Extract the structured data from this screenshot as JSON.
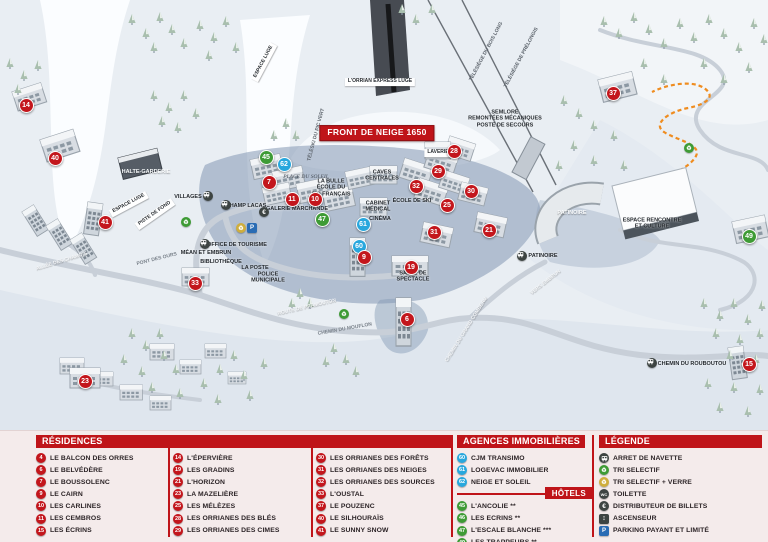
{
  "colors": {
    "red": "#c3161c",
    "blue": "#28a7dd",
    "green": "#3e9b35",
    "dark": "#3d4442",
    "parking": "#2a6cb4",
    "glass": "#cfae3d",
    "header_red": "#bf1419",
    "panel_bg": "#f4ebeb",
    "luge_orange": "#ef8c1f"
  },
  "panel": {
    "residences": {
      "header": "RÉSIDENCES",
      "columns": [
        [
          {
            "n": 4,
            "label": "LE BALCON DES ORRES"
          },
          {
            "n": 6,
            "label": "LE BELVÉDÈRE"
          },
          {
            "n": 7,
            "label": "LE BOUSSOLENC"
          },
          {
            "n": 9,
            "label": "LE CAIRN"
          },
          {
            "n": 10,
            "label": "LES CARLINES"
          },
          {
            "n": 11,
            "label": "LES CEMBROS"
          },
          {
            "n": 15,
            "label": "LES ÉCRINS"
          }
        ],
        [
          {
            "n": 14,
            "label": "L'ÉPERVIÈRE"
          },
          {
            "n": 19,
            "label": "LES GRADINS"
          },
          {
            "n": 21,
            "label": "L'HORIZON"
          },
          {
            "n": 23,
            "label": "LA MAZELIÈRE"
          },
          {
            "n": 25,
            "label": "LES MÉLÈZES"
          },
          {
            "n": 28,
            "label": "LES ORRIANES DES BLÉS"
          },
          {
            "n": 29,
            "label": "LES ORRIANES DES CIMES"
          }
        ],
        [
          {
            "n": 30,
            "label": "LES ORRIANES DES FORÊTS"
          },
          {
            "n": 31,
            "label": "LES ORRIANES DES NEIGES"
          },
          {
            "n": 32,
            "label": "LES ORRIANES DES SOURCES"
          },
          {
            "n": 33,
            "label": "L'OUSTAL"
          },
          {
            "n": 37,
            "label": "LE POUZENC"
          },
          {
            "n": 40,
            "label": "LE SILHOURAÏS"
          },
          {
            "n": 41,
            "label": "LE SUNNY SNOW"
          }
        ]
      ]
    },
    "agencies": {
      "header": "AGENCES IMMOBILIÈRES",
      "items": [
        {
          "n": 60,
          "label": "CJM TRANSIMO"
        },
        {
          "n": 61,
          "label": "LOGEVAC IMMOBILIER"
        },
        {
          "n": 62,
          "label": "NEIGE ET SOLEIL"
        }
      ]
    },
    "hotels": {
      "header": "HÔTELS",
      "items": [
        {
          "n": 45,
          "label": "L'ANCOLIE **"
        },
        {
          "n": 46,
          "label": "LES ECRINS **"
        },
        {
          "n": 47,
          "label": "L'ESCALE BLANCHE ***"
        },
        {
          "n": 49,
          "label": "LES TRAPPEURS **"
        }
      ]
    },
    "legende": {
      "header": "LÉGENDE",
      "items": [
        {
          "icon": "bus-icon",
          "label": "ARRET DE NAVETTE"
        },
        {
          "icon": "recycle-icon",
          "label": "TRI SELECTIF"
        },
        {
          "icon": "recycle-glass-icon",
          "label": "TRI SELECTIF + VERRE"
        },
        {
          "icon": "toilet-icon",
          "label": "TOILETTE"
        },
        {
          "icon": "euro-icon",
          "label": "DISTRIBUTEUR DE BILLETS"
        },
        {
          "icon": "elevator-icon",
          "label": "ASCENSEUR"
        },
        {
          "icon": "parking-icon",
          "label": "PARKING PAYANT ET LIMITÉ"
        }
      ]
    }
  },
  "map": {
    "banner": "FRONT DE NEIGE 1650",
    "markers": [
      {
        "n": 14,
        "x": 25,
        "y": 104,
        "c": "r"
      },
      {
        "n": 40,
        "x": 54,
        "y": 157,
        "c": "r"
      },
      {
        "n": 41,
        "x": 104,
        "y": 221,
        "c": "r"
      },
      {
        "n": 33,
        "x": 194,
        "y": 282,
        "c": "r"
      },
      {
        "n": 23,
        "x": 84,
        "y": 380,
        "c": "r"
      },
      {
        "n": 7,
        "x": 268,
        "y": 181,
        "c": "r"
      },
      {
        "n": 45,
        "x": 265,
        "y": 156,
        "c": "g"
      },
      {
        "n": 62,
        "x": 283,
        "y": 163,
        "c": "b"
      },
      {
        "n": 11,
        "x": 291,
        "y": 198,
        "c": "r"
      },
      {
        "n": 10,
        "x": 314,
        "y": 198,
        "c": "r"
      },
      {
        "n": 47,
        "x": 321,
        "y": 218,
        "c": "g"
      },
      {
        "n": 61,
        "x": 362,
        "y": 223,
        "c": "b"
      },
      {
        "n": 32,
        "x": 415,
        "y": 185,
        "c": "r"
      },
      {
        "n": 29,
        "x": 437,
        "y": 170,
        "c": "r"
      },
      {
        "n": 28,
        "x": 453,
        "y": 150,
        "c": "r"
      },
      {
        "n": 25,
        "x": 446,
        "y": 204,
        "c": "r"
      },
      {
        "n": 30,
        "x": 470,
        "y": 190,
        "c": "r"
      },
      {
        "n": 21,
        "x": 488,
        "y": 229,
        "c": "r"
      },
      {
        "n": 31,
        "x": 433,
        "y": 231,
        "c": "r"
      },
      {
        "n": 60,
        "x": 358,
        "y": 245,
        "c": "b"
      },
      {
        "n": 9,
        "x": 363,
        "y": 256,
        "c": "r"
      },
      {
        "n": 19,
        "x": 410,
        "y": 266,
        "c": "r"
      },
      {
        "n": 6,
        "x": 406,
        "y": 318,
        "c": "r"
      },
      {
        "n": 37,
        "x": 612,
        "y": 92,
        "c": "r"
      },
      {
        "n": 49,
        "x": 748,
        "y": 235,
        "c": "g"
      },
      {
        "n": 15,
        "x": 748,
        "y": 363,
        "c": "r"
      }
    ],
    "labels": [
      {
        "t": "FRONT DE NEIGE 1650",
        "x": 377,
        "y": 133,
        "k": "banner"
      },
      {
        "t": "L'ORRIAN EXPRESS\nLUGE",
        "x": 380,
        "y": 82,
        "k": "box"
      },
      {
        "t": "ESPACE LUGE",
        "x": 264,
        "y": 62,
        "k": "box",
        "r": -62
      },
      {
        "t": "ESPACE LUGE",
        "x": 129,
        "y": 204,
        "k": "box",
        "r": -28
      },
      {
        "t": "PISTE DE FOND",
        "x": 155,
        "y": 214,
        "k": "box",
        "r": -35
      },
      {
        "t": "TÉLÉSKI DU PIC VERT",
        "x": 317,
        "y": 135,
        "k": "lift",
        "r": -75
      },
      {
        "t": "TÉLÉSIÈGE DU BOIS LONG",
        "x": 487,
        "y": 52,
        "k": "lift",
        "r": -62
      },
      {
        "t": "TÉLÉSIÈGE DE PRÉLONGIS",
        "x": 522,
        "y": 58,
        "k": "lift",
        "r": -62
      },
      {
        "t": "SEMLORE\nREMONTÉES MÉCANIQUES\nPOSTE DE SECOURS",
        "x": 505,
        "y": 119,
        "k": "plain"
      },
      {
        "t": "LAVERIE",
        "x": 438,
        "y": 153,
        "k": "box"
      },
      {
        "t": "HALTE-GARDERIE",
        "x": 146,
        "y": 172,
        "k": "wlabel"
      },
      {
        "t": "PLACE DU SOLEIL",
        "x": 306,
        "y": 177,
        "k": "it"
      },
      {
        "t": "LA BULLE\nÉCOLE DU\nSKI FRANÇAIS",
        "x": 331,
        "y": 188,
        "k": "plain"
      },
      {
        "t": "CAVES\nCENTRALES",
        "x": 382,
        "y": 176,
        "k": "plain"
      },
      {
        "t": "ÉCOLE DE SKI",
        "x": 412,
        "y": 201,
        "k": "plain"
      },
      {
        "t": "GALERIE MARCHANDE",
        "x": 297,
        "y": 209,
        "k": "plain"
      },
      {
        "t": "CABINET\nMÉDICAL",
        "x": 378,
        "y": 207,
        "k": "plain"
      },
      {
        "t": "CINÉMA",
        "x": 380,
        "y": 219,
        "k": "plain"
      },
      {
        "t": "VILLAGES",
        "x": 188,
        "y": 197,
        "k": "stop"
      },
      {
        "t": "CHAMP LACAS",
        "x": 246,
        "y": 206,
        "k": "stop"
      },
      {
        "t": "MÉAN ET EMBRUN",
        "x": 206,
        "y": 253,
        "k": "stop"
      },
      {
        "t": "BIBLIOTHÈQUE",
        "x": 221,
        "y": 262,
        "k": "plain"
      },
      {
        "t": "OFFICE DE TOURISME",
        "x": 237,
        "y": 245,
        "k": "plain"
      },
      {
        "t": "LA POSTE",
        "x": 255,
        "y": 268,
        "k": "plain"
      },
      {
        "t": "POLICE\nMUNICIPALE",
        "x": 268,
        "y": 278,
        "k": "plain"
      },
      {
        "t": "SALLE DE\nSPECTACLE",
        "x": 413,
        "y": 277,
        "k": "plain"
      },
      {
        "t": "PATINOIRE",
        "x": 572,
        "y": 213,
        "k": "wlabel"
      },
      {
        "t": "ESPACE RENCONTRE\nET CULTURE",
        "x": 652,
        "y": 224,
        "k": "plain"
      },
      {
        "t": "PATINOIRE",
        "x": 543,
        "y": 256,
        "k": "stop"
      },
      {
        "t": "VERS EMBRUN",
        "x": 546,
        "y": 283,
        "k": "roadw",
        "r": -38
      },
      {
        "t": "ALLÉE DES CHAMOIS",
        "x": 62,
        "y": 262,
        "k": "roadw",
        "r": -17
      },
      {
        "t": "PONT DES OURS",
        "x": 157,
        "y": 260,
        "k": "road",
        "r": -14
      },
      {
        "t": "ROUTE DE PRAMOUTON",
        "x": 307,
        "y": 308,
        "k": "roadw",
        "r": -13
      },
      {
        "t": "CHEMIN DU MOUFLON",
        "x": 345,
        "y": 330,
        "k": "road",
        "r": -10
      },
      {
        "t": "CHEMIN DU GRAND COMBEAU",
        "x": 467,
        "y": 330,
        "k": "roadw",
        "r": -58
      },
      {
        "t": "CHEMIN DU ROUBOUTOU",
        "x": 692,
        "y": 364,
        "k": "stop"
      }
    ],
    "icons": [
      {
        "t": "bus-icon",
        "x": 208,
        "y": 196
      },
      {
        "t": "bus-icon",
        "x": 226,
        "y": 205
      },
      {
        "t": "bus-icon",
        "x": 205,
        "y": 244
      },
      {
        "t": "bus-icon",
        "x": 522,
        "y": 256
      },
      {
        "t": "bus-icon",
        "x": 652,
        "y": 363
      },
      {
        "t": "euro-icon",
        "x": 264,
        "y": 212
      },
      {
        "t": "parking-icon",
        "x": 252,
        "y": 228
      },
      {
        "t": "recycle-glass-icon",
        "x": 241,
        "y": 228
      },
      {
        "t": "recycle-icon",
        "x": 186,
        "y": 222
      },
      {
        "t": "recycle-icon",
        "x": 344,
        "y": 314
      },
      {
        "t": "recycle-icon",
        "x": 689,
        "y": 148
      }
    ]
  }
}
